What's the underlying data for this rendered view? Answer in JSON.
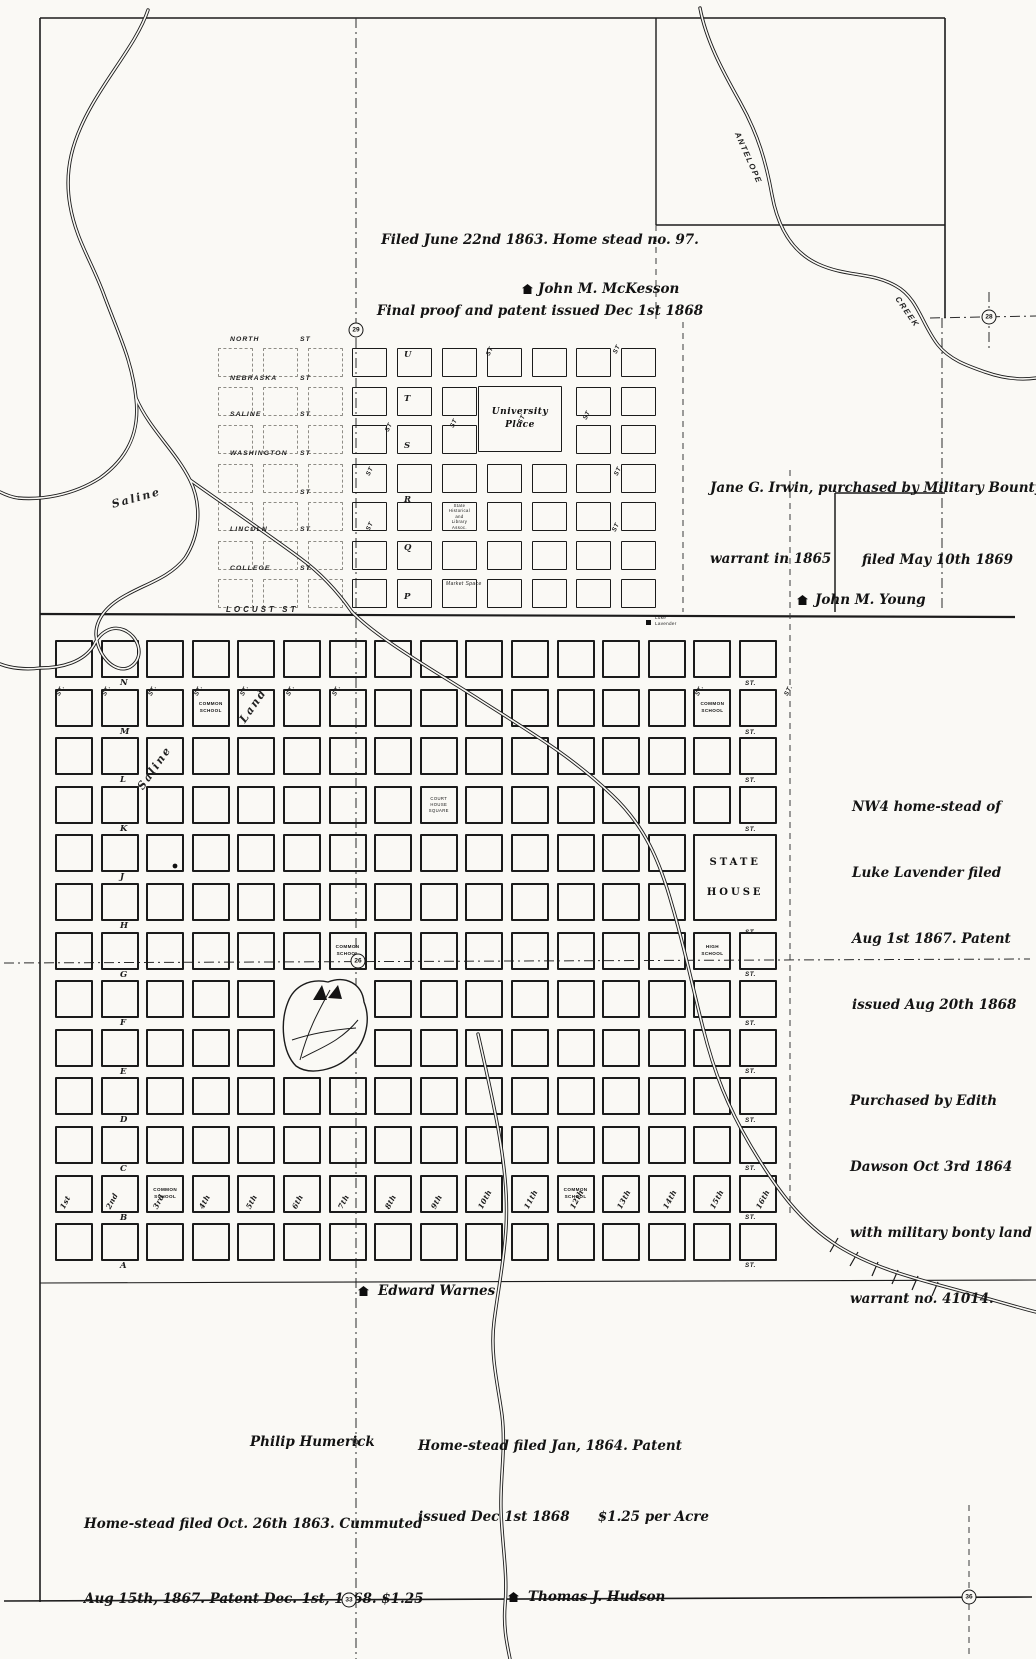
{
  "colors": {
    "paper": "#faf9f5",
    "ink": "#1b1b1b"
  },
  "notes": {
    "mckesson_claim": {
      "line1": "Filed June 22nd 1863. Home stead no. 97.",
      "line2": "Final proof and patent issued Dec 1st 1868"
    },
    "irwin": {
      "line1": "Jane G. Irwin, purchased by Military Bounty",
      "line2": "warrant in 1865"
    },
    "filed_1869": {
      "line1": "filed May 10th 1869"
    },
    "lavender": {
      "line1": "NW4 home-stead of",
      "line2": "Luke Lavender filed",
      "line3": "Aug 1st 1867. Patent",
      "line4": "issued Aug 20th 1868"
    },
    "dawson": {
      "line1": "Purchased by Edith",
      "line2": "Dawson Oct 3rd 1864",
      "line3": "with military bonty land",
      "line4": "warrant no. 41014."
    },
    "jan_1864": {
      "line1": "Home-stead filed Jan, 1864. Patent",
      "line2": "issued Dec 1st 1868      $1.25 per Acre"
    },
    "humerick_claim": {
      "line1": "Home-stead filed Oct. 26th 1863. Cummuted",
      "line2": "Aug 15th, 1867. Patent Dec. 1st, 1868. $1.25",
      "line3": "per acre."
    }
  },
  "settlers": {
    "mckesson": "John M. McKesson",
    "young": "John M. Young",
    "warnes": "Edward Warnes",
    "humerick": "Philip Humerick",
    "hudson": "Thomas J. Hudson"
  },
  "waterways": {
    "saline_upper": "Saline",
    "saline_lower": "Saline",
    "land": "Land",
    "antelope": "ANTELOPE",
    "creek": "CREEK"
  },
  "upper_plat": {
    "streets": [
      "NORTH",
      "NEBRASKA",
      "SALINE",
      "WASHINGTON",
      "",
      "LINCOLN",
      "COLLEGE"
    ],
    "st_suffix": "ST",
    "locust": "LOCUST  ST",
    "row_letters": [
      "U",
      "T",
      "S",
      "R",
      "Q",
      "P"
    ],
    "st_label": "ST",
    "university_place": [
      "University",
      "Place"
    ],
    "historical_assoc": [
      "State",
      "Historical",
      "and",
      "Library",
      "Assoc."
    ],
    "market_space": "Market Space"
  },
  "lower_plat": {
    "row_letters": [
      "N",
      "M",
      "L",
      "K",
      "J",
      "H",
      "G",
      "F",
      "E",
      "D",
      "C",
      "B",
      "A"
    ],
    "numbered_streets": [
      "1st",
      "2nd",
      "3rd",
      "4th",
      "5th",
      "6th",
      "7th",
      "8th",
      "9th",
      "10th",
      "11th",
      "12th",
      "13th",
      "14th",
      "15th",
      "16th"
    ],
    "st_label": "ST.",
    "blocks": {
      "common_school": [
        "COMMON",
        "SCHOOL"
      ],
      "court_house": [
        "COURT",
        "HOUSE",
        "SQUARE"
      ],
      "state_house": [
        "STATE",
        "HOUSE"
      ],
      "high_school": [
        "HIGH",
        "SCHOOL"
      ],
      "lavender_cabin": [
        "Luke",
        "Lavender"
      ]
    }
  },
  "section_markers": [
    {
      "label": "29"
    },
    {
      "label": "28"
    },
    {
      "label": "26"
    },
    {
      "label": "33"
    },
    {
      "label": "36"
    }
  ]
}
